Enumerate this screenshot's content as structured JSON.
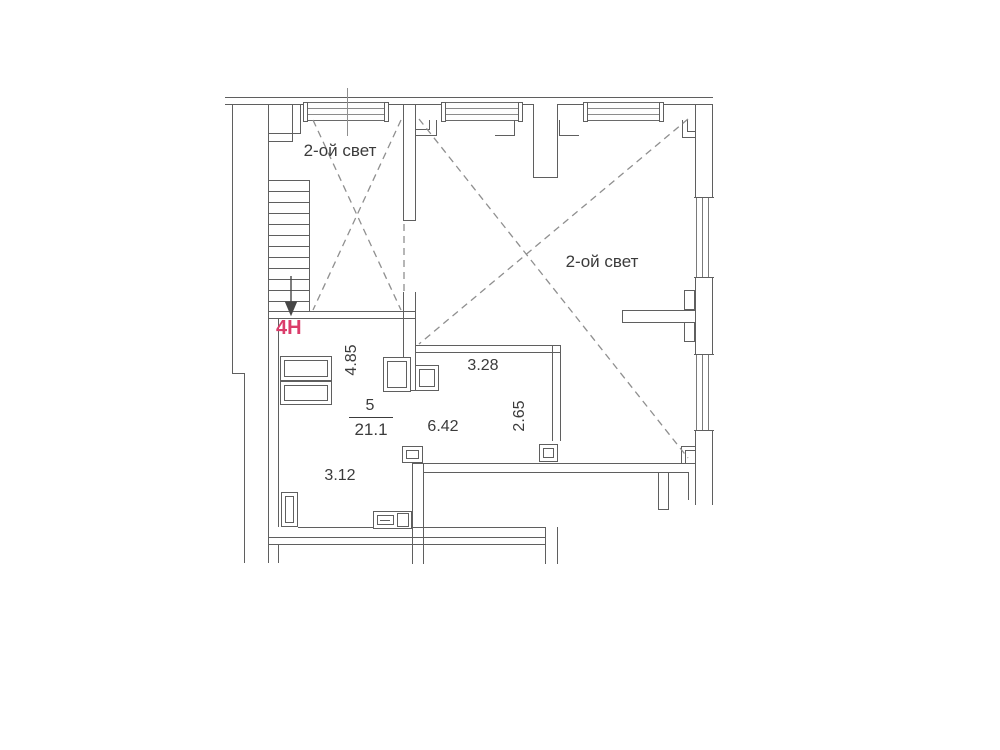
{
  "plan": {
    "kind": "floor-plan",
    "labels": {
      "double_light_1": "2-ой свет",
      "double_light_2": "2-ой свет",
      "unit": "4H"
    },
    "room": {
      "number": "5",
      "area": "21.1"
    },
    "dimensions": {
      "left_vertical": "4.85",
      "top_horizontal": "3.28",
      "right_vertical": "2.65",
      "middle_horizontal": "6.42",
      "bottom_horizontal": "3.12"
    },
    "colors": {
      "accent": "#db3d6b",
      "wall_line": "#5f5f5f",
      "dashed_line": "#8f8f8f",
      "text": "#3b3b3b"
    }
  }
}
